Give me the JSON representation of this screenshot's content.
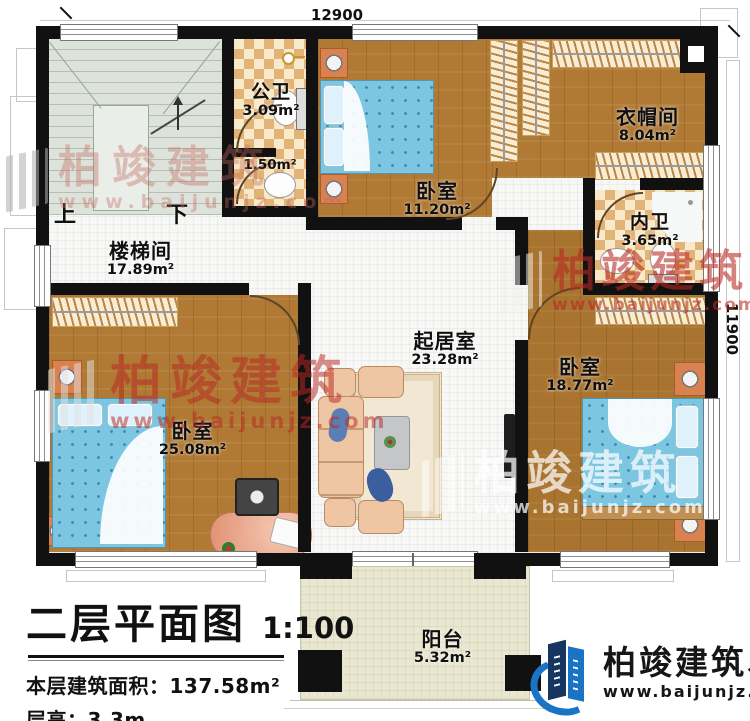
{
  "plan": {
    "dim_top": "12900",
    "dim_right": "11900"
  },
  "stairs": {
    "up": "上",
    "down": "下"
  },
  "rooms": {
    "stairwell": {
      "name": "楼梯间",
      "area": "17.89m²"
    },
    "public_bath": {
      "name": "公卫",
      "area": "3.09m²"
    },
    "wash_nook": {
      "area": "1.50m²"
    },
    "bedroom_top": {
      "name": "卧室",
      "area": "11.20m²"
    },
    "cloakroom": {
      "name": "衣帽间",
      "area": "8.04m²"
    },
    "master_bath": {
      "name": "内卫",
      "area": "3.65m²"
    },
    "living_room": {
      "name": "起居室",
      "area": "23.28m²"
    },
    "bedroom_right": {
      "name": "卧室",
      "area": "18.77m²"
    },
    "bedroom_left": {
      "name": "卧室",
      "area": "25.08m²"
    },
    "balcony": {
      "name": "阳台",
      "area": "5.32m²"
    }
  },
  "title_block": {
    "title": "二层平面图",
    "scale": "1:100",
    "area_label": "本层建筑面积：",
    "area_value": "137.58m²",
    "height_label": "层高：",
    "height_value": "3.3m"
  },
  "watermark": {
    "brand": "柏竣建筑",
    "url": "www.baijunjz.com"
  },
  "logo": {
    "brand": "柏竣建筑",
    "accent": "、",
    "url": "www.baijunjz.com"
  },
  "colors": {
    "wall": "#111111",
    "wood": "#b07a35",
    "tile": "#f6f7f5",
    "checker_dark": "#e2b377",
    "checker_light": "#f7e9c9",
    "stairs": "#dde3da",
    "balcony": "#eae7d0",
    "bed_blue": "#7cc6e2",
    "watermark_red": "#c23a32",
    "logo_blue": "#1a73c4",
    "logo_navy": "#16355f"
  }
}
